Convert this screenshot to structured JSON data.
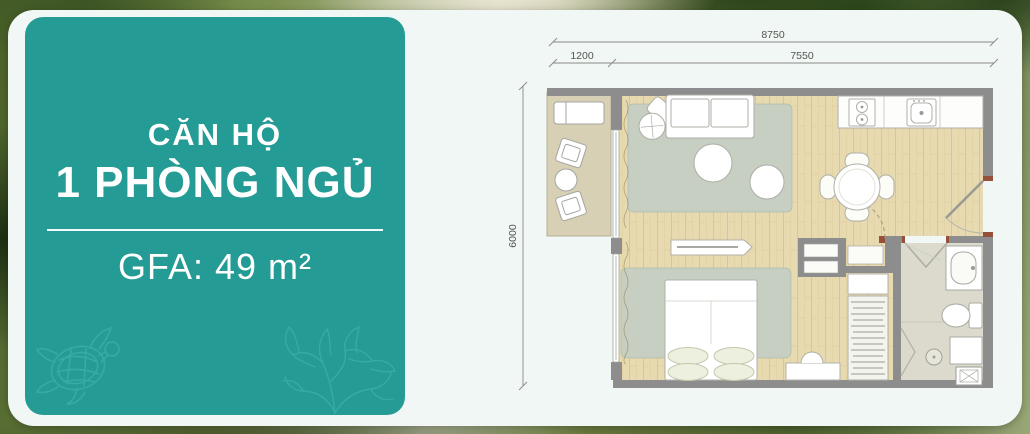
{
  "panel": {
    "title_line1": "CĂN HỘ",
    "title_line2": "1 PHÒNG NGỦ",
    "gfa_text": "GFA: 49 m²",
    "accent_color": "#249b94",
    "decor_stroke_color": "#40b7ae",
    "decor_left": "turtle-icon",
    "decor_right": "coral-icon"
  },
  "floorplan": {
    "dimensions": {
      "total_width": "8750",
      "balcony_width": "1200",
      "interior_width": "7550",
      "total_depth": "6000"
    },
    "colors": {
      "wall": "#8d8d8d",
      "wood_floor": "#e8dab0",
      "balcony_floor": "#d8d0b4",
      "rug": "#c6cfc1",
      "bath_floor": "#dbdacd",
      "dimension_text": "#55554f"
    }
  }
}
